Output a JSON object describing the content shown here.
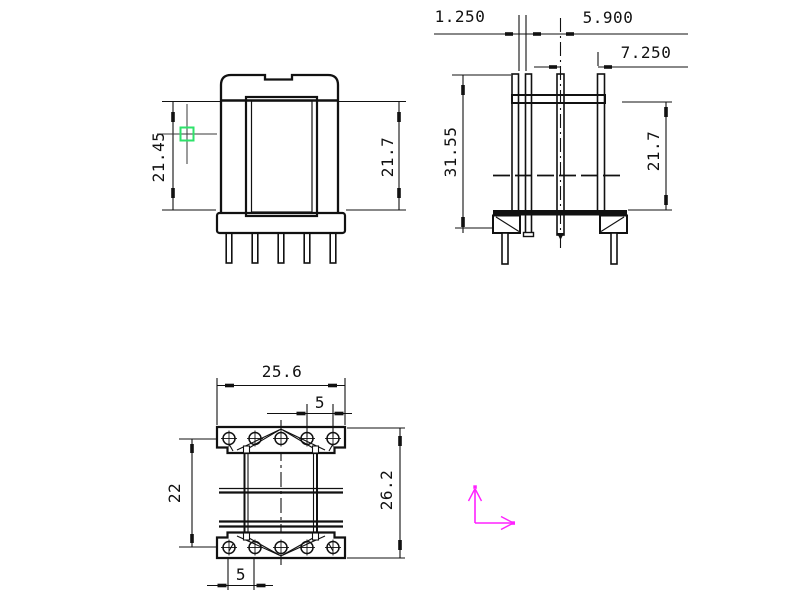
{
  "colors": {
    "line": "#111111",
    "crosshair": "#3a3a3a",
    "pickbox": "#2ee26a",
    "ucs_axes": "#ff22ff"
  },
  "front_view": {
    "dim_left": "21.45",
    "dim_right": "21.7"
  },
  "side_view": {
    "dim_top_inner": "1.250",
    "dim_top_middle": "5.900",
    "dim_top_outer": "7.250",
    "dim_left": "31.55",
    "dim_right": "21.7"
  },
  "plan_view": {
    "dim_top_width": "25.6",
    "dim_top_pitch": "5",
    "dim_left": "22",
    "dim_right": "26.2",
    "dim_bottom_pitch": "5"
  }
}
